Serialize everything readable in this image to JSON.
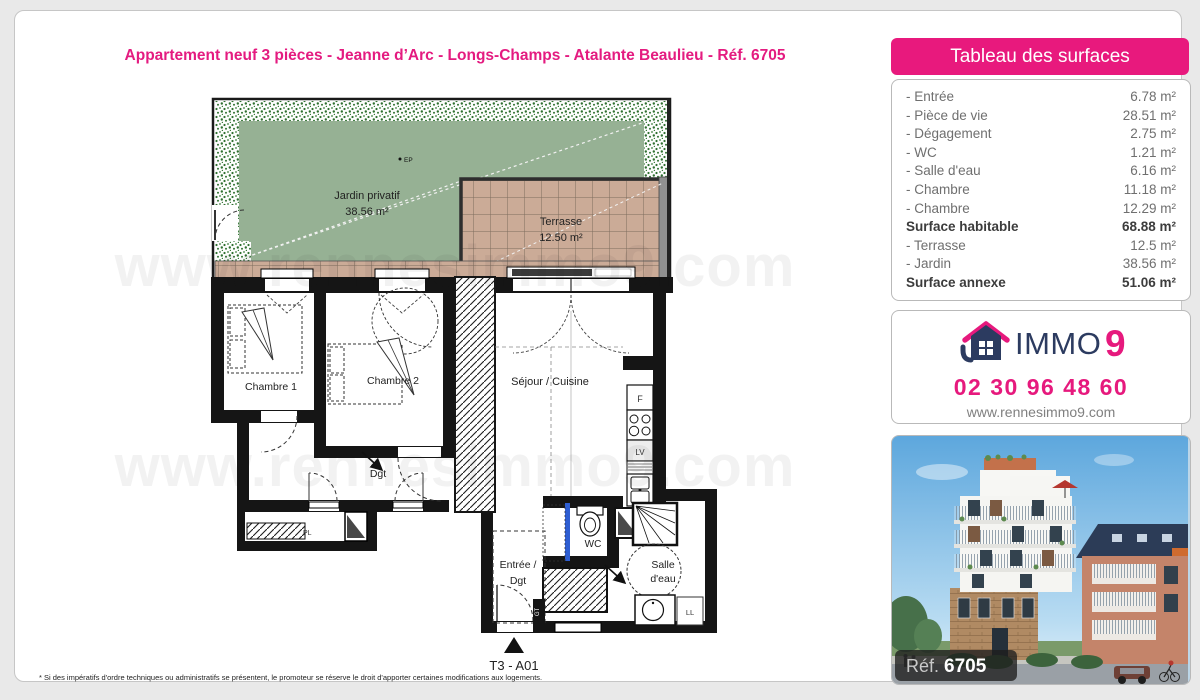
{
  "page": {
    "title": "Appartement neuf 3 pièces - Jeanne d’Arc - Longs-Champs - Atalante Beaulieu - Réf. 6705",
    "footnote": "* Si des impératifs d'ordre techniques ou administratifs se présentent, le promoteur se réserve le droit d'apporter certaines modifications aux logements."
  },
  "surfaces_panel": {
    "header": "Tableau des surfaces",
    "rows": [
      {
        "label": "- Entrée",
        "value": "6.78 m²"
      },
      {
        "label": "- Pièce de vie",
        "value": "28.51 m²"
      },
      {
        "label": "- Dégagement",
        "value": "2.75 m²"
      },
      {
        "label": "- WC",
        "value": "1.21 m²"
      },
      {
        "label": "- Salle d'eau",
        "value": "6.16 m²"
      },
      {
        "label": "- Chambre",
        "value": "11.18 m²"
      },
      {
        "label": "- Chambre",
        "value": "12.29 m²"
      },
      {
        "label": "Surface habitable",
        "value": "68.88 m²"
      },
      {
        "label": "- Terrasse",
        "value": "12.5 m²"
      },
      {
        "label": "- Jardin",
        "value": "38.56 m²"
      },
      {
        "label": "Surface annexe",
        "value": "51.06 m²"
      }
    ]
  },
  "contact": {
    "brand_immo": "IMMO",
    "brand_9": "9",
    "phone": "02 30 96 48 60",
    "website": "www.rennesimmo9.com"
  },
  "photo": {
    "ref_label": "Réf.",
    "ref_number": "6705"
  },
  "plan": {
    "watermark": "www.rennesimmo9.com",
    "unit_label": "T3 - A01",
    "garden": {
      "name": "Jardin privatif",
      "area": "38.56 m²",
      "ep": "EP"
    },
    "terrace": {
      "name": "Terrasse",
      "area": "12.50 m²"
    },
    "rooms": {
      "bedroom1": "Chambre 1",
      "bedroom2": "Chambre 2",
      "living": "Séjour / Cuisine",
      "hall": "Dgt",
      "entry_line1": "Entrée /",
      "entry_line2": "Dgt",
      "wc": "WC",
      "bath_line1": "Salle",
      "bath_line2": "d'eau",
      "closet": "PL",
      "gt": "GT",
      "washer": "LL",
      "fridge": "F",
      "dishwasher": "LV"
    }
  }
}
